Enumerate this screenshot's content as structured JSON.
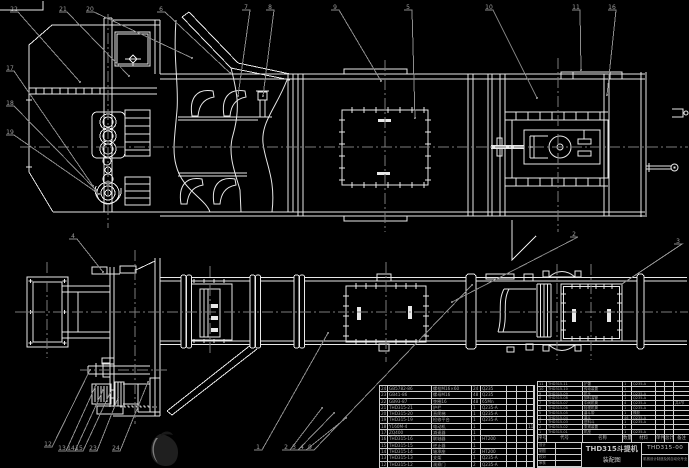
{
  "colors": {
    "background": "#000000",
    "line": "#e8e8e8",
    "annotation": "#8c8c8c",
    "table_text": "#a8a8a8"
  },
  "title_block": {
    "product": "THD315斗提机",
    "doc_type": "装配图",
    "drawing_no": "THD315-00",
    "org": "机械设计制造及其自动化专业",
    "signature_rows": [
      "设计",
      "制图",
      "校对",
      "审核"
    ]
  },
  "bom": {
    "columns": [
      "序号",
      "代号",
      "名称",
      "数量",
      "材料",
      "单件",
      "总计",
      "备注"
    ],
    "right": {
      "rows": [
        {
          "no": "11",
          "code": "THD315-11",
          "name": "护罩",
          "qty": "1",
          "mat": "Q235-A",
          "unit": "",
          "total": "",
          "note": ""
        },
        {
          "no": "10",
          "code": "THD315-10",
          "name": "传动装置",
          "qty": "1",
          "mat": "",
          "unit": "",
          "total": "",
          "note": ""
        },
        {
          "no": "9",
          "code": "THD315-09",
          "name": "机头",
          "qty": "1",
          "mat": "Q235-A",
          "unit": "",
          "total": "",
          "note": ""
        },
        {
          "no": "8",
          "code": "THD315-08",
          "name": "卸料溜管",
          "qty": "1",
          "mat": "Q235-A",
          "unit": "",
          "total": "",
          "note": ""
        },
        {
          "no": "7",
          "code": "THD315-07",
          "name": "中间机筒",
          "qty": "4",
          "mat": "Q235-A",
          "unit": "",
          "total": "",
          "note": "共4节"
        },
        {
          "no": "6",
          "code": "THD315-06",
          "name": "检视机筒",
          "qty": "1",
          "mat": "Q235-A",
          "unit": "",
          "total": "",
          "note": ""
        },
        {
          "no": "5",
          "code": "THD315-05",
          "name": "畚斗带",
          "qty": "1",
          "mat": "橡胶",
          "unit": "",
          "total": "",
          "note": ""
        },
        {
          "no": "4",
          "code": "THD315-04",
          "name": "畚斗",
          "qty": "46",
          "mat": "Q235-A",
          "unit": "",
          "total": "",
          "note": ""
        },
        {
          "no": "3",
          "code": "THD315-03",
          "name": "进料斗",
          "qty": "1",
          "mat": "Q235-A",
          "unit": "",
          "total": "",
          "note": ""
        },
        {
          "no": "2",
          "code": "THD315-02",
          "name": "张紧装置",
          "qty": "1",
          "mat": "",
          "unit": "",
          "total": "",
          "note": ""
        },
        {
          "no": "1",
          "code": "THD315-01",
          "name": "机座",
          "qty": "1",
          "mat": "Q235-A",
          "unit": "",
          "total": "",
          "note": ""
        }
      ]
    },
    "left": {
      "rows": [
        {
          "no": "24",
          "code": "GB5782-86",
          "name": "螺栓M16×60",
          "qty": "24",
          "mat": "Q235",
          "unit": "",
          "total": "",
          "note": ""
        },
        {
          "no": "23",
          "code": "GB41-86",
          "name": "螺母M16",
          "qty": "48",
          "mat": "Q235",
          "unit": "",
          "total": "",
          "note": ""
        },
        {
          "no": "22",
          "code": "GB93-87",
          "name": "垫圈16",
          "qty": "48",
          "mat": "65Mn",
          "unit": "",
          "total": "",
          "note": ""
        },
        {
          "no": "21",
          "code": "THD315-21",
          "name": "护栏",
          "qty": "1",
          "mat": "Q235-A",
          "unit": "",
          "total": "",
          "note": ""
        },
        {
          "no": "20",
          "code": "THD315-20",
          "name": "直爬梯",
          "qty": "1",
          "mat": "Q235-A",
          "unit": "",
          "total": "",
          "note": ""
        },
        {
          "no": "19",
          "code": "THD315-19",
          "name": "检修平台",
          "qty": "1",
          "mat": "Q235-A",
          "unit": "",
          "total": "",
          "note": ""
        },
        {
          "no": "18",
          "code": "Y160M-4",
          "name": "电动机",
          "qty": "1",
          "mat": "",
          "unit": "",
          "total": "",
          "note": "11kW"
        },
        {
          "no": "17",
          "code": "ZQ400",
          "name": "减速器",
          "qty": "1",
          "mat": "",
          "unit": "",
          "total": "",
          "note": ""
        },
        {
          "no": "16",
          "code": "THD315-16",
          "name": "联轴器",
          "qty": "1",
          "mat": "HT200",
          "unit": "",
          "total": "",
          "note": ""
        },
        {
          "no": "15",
          "code": "THD315-15",
          "name": "逆止器",
          "qty": "1",
          "mat": "",
          "unit": "",
          "total": "",
          "note": ""
        },
        {
          "no": "14",
          "code": "THD315-14",
          "name": "轴承座",
          "qty": "2",
          "mat": "HT200",
          "unit": "",
          "total": "",
          "note": ""
        },
        {
          "no": "13",
          "code": "THD315-13",
          "name": "支架",
          "qty": "1",
          "mat": "Q235-A",
          "unit": "",
          "total": "",
          "note": ""
        },
        {
          "no": "12",
          "code": "THD315-12",
          "name": "观察门",
          "qty": "2",
          "mat": "Q235-A",
          "unit": "",
          "total": "",
          "note": ""
        }
      ]
    }
  },
  "callouts": [
    {
      "n": "22",
      "x": 14,
      "y": 9,
      "tx": 80,
      "ty": 82
    },
    {
      "n": "21",
      "x": 63,
      "y": 9,
      "tx": 129,
      "ty": 76
    },
    {
      "n": "20",
      "x": 90,
      "y": 9,
      "tx": 192,
      "ty": 58
    },
    {
      "n": "6",
      "x": 161,
      "y": 9,
      "tx": 230,
      "ty": 73
    },
    {
      "n": "7",
      "x": 246,
      "y": 7,
      "tx": 238,
      "ty": 96
    },
    {
      "n": "8",
      "x": 270,
      "y": 7,
      "tx": 263,
      "ty": 96
    },
    {
      "n": "9",
      "x": 335,
      "y": 7,
      "tx": 381,
      "ty": 81
    },
    {
      "n": "5",
      "x": 408,
      "y": 7,
      "tx": 415,
      "ty": 118
    },
    {
      "n": "10",
      "x": 489,
      "y": 7,
      "tx": 537,
      "ty": 98
    },
    {
      "n": "11",
      "x": 576,
      "y": 7,
      "tx": 581,
      "ty": 70
    },
    {
      "n": "16",
      "x": 612,
      "y": 7,
      "tx": 607,
      "ty": 95
    },
    {
      "n": "17",
      "x": 10,
      "y": 68,
      "tx": 93,
      "ty": 186
    },
    {
      "n": "18",
      "x": 10,
      "y": 103,
      "tx": 96,
      "ty": 190
    },
    {
      "n": "19",
      "x": 10,
      "y": 132,
      "tx": 99,
      "ty": 194
    },
    {
      "n": "4",
      "x": 73,
      "y": 236,
      "tx": 103,
      "ty": 272
    },
    {
      "n": "2",
      "x": 574,
      "y": 234,
      "tx": 452,
      "ty": 302
    },
    {
      "n": "3",
      "x": 678,
      "y": 241,
      "tx": 622,
      "ty": 284
    },
    {
      "n": "12",
      "x": 48,
      "y": 444,
      "tx": 90,
      "ty": 370
    },
    {
      "n": "13",
      "x": 62,
      "y": 448,
      "tx": 96,
      "ty": 385
    },
    {
      "n": "14",
      "x": 71,
      "y": 448,
      "tx": 103,
      "ty": 390
    },
    {
      "n": "15",
      "x": 79,
      "y": 448,
      "tx": 110,
      "ty": 393
    },
    {
      "n": "23",
      "x": 93,
      "y": 448,
      "tx": 118,
      "ty": 398
    },
    {
      "n": "24",
      "x": 116,
      "y": 448,
      "tx": 148,
      "ty": 382
    },
    {
      "n": "1",
      "x": 258,
      "y": 447,
      "tx": 328,
      "ty": 333
    },
    {
      "n": "2",
      "x": 286,
      "y": 447,
      "tx": 322,
      "ty": 408
    },
    {
      "n": "3",
      "x": 294,
      "y": 447,
      "tx": 334,
      "ty": 413
    },
    {
      "n": "4",
      "x": 302,
      "y": 447,
      "tx": 346,
      "ty": 418
    },
    {
      "n": "9",
      "x": 310,
      "y": 447,
      "tx": 472,
      "ty": 285
    }
  ]
}
